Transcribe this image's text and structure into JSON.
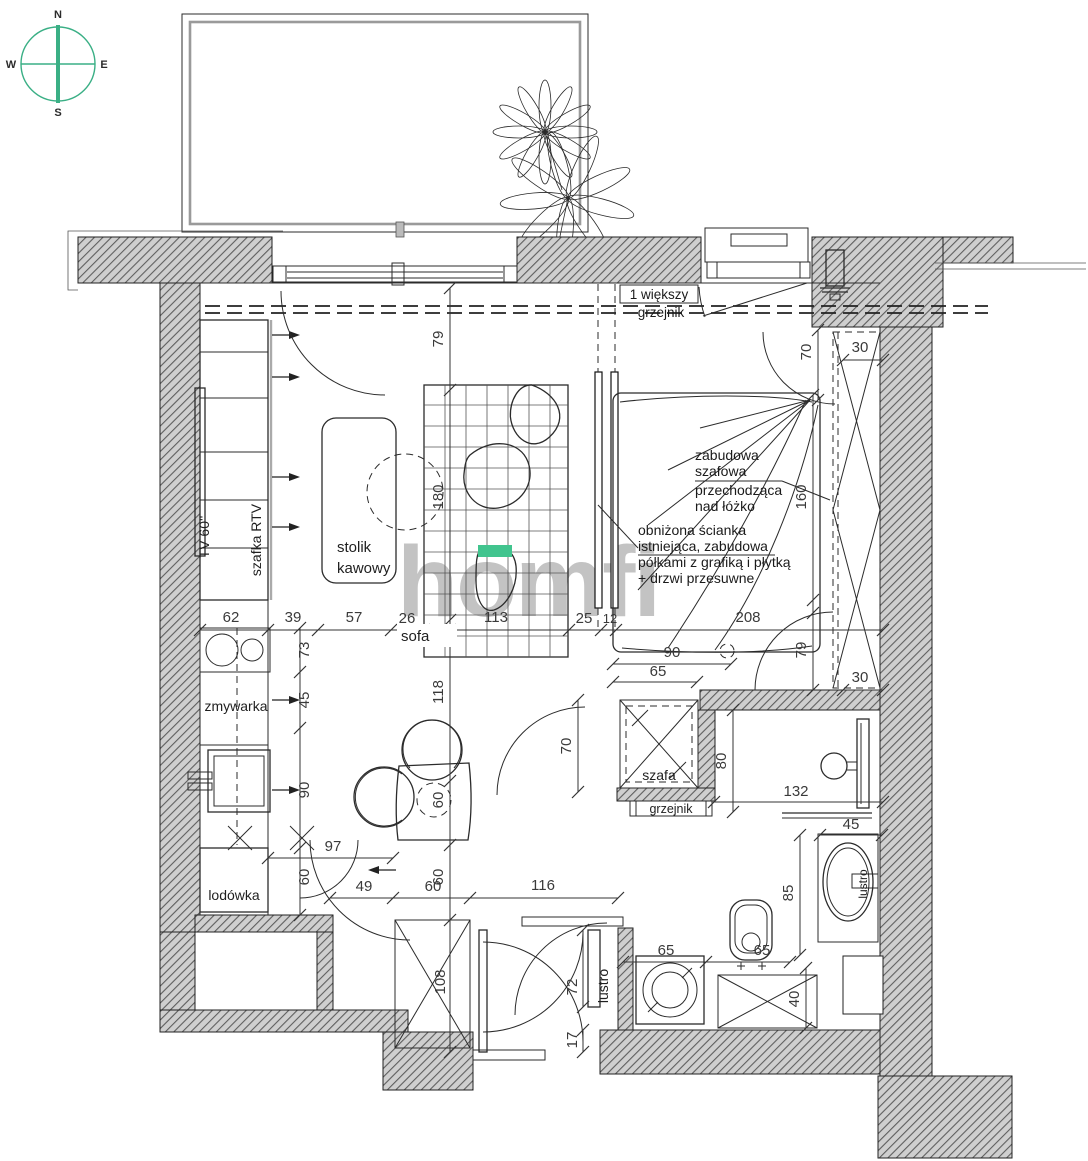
{
  "watermark": "homfi",
  "compass": {
    "n": "N",
    "e": "E",
    "s": "S",
    "w": "W"
  },
  "rooms": {
    "sofa": "sofa",
    "stolik_line1": "stolik",
    "stolik_line2": "kawowy",
    "tv": "TV 60''",
    "szafka_rtv": "szafka RTV",
    "zmywarka": "zmywarka",
    "lodowka": "lodówka",
    "szafa": "szafa",
    "grzejnik": "grzejnik",
    "lustro_bathroom": "lustro",
    "lustro_hall": "lustro"
  },
  "notes": {
    "bigger_radiator_line1": "1 większy",
    "bigger_radiator_line2": "grzejnik",
    "wardrobe_over_bed": [
      "zabudowa",
      "szafowa",
      "przechodząca",
      "nad łóżko"
    ],
    "lowered_wall": [
      "obniżona ścianka",
      "istniejąca, zabudowa",
      "półkami z grafiką i płytką",
      "+ drzwi przesuwne"
    ]
  },
  "dims": {
    "top_chain": [
      "62",
      "39",
      "57",
      "26",
      "113",
      "25",
      "12",
      "208"
    ],
    "living_vertical": [
      "79",
      "180",
      "118",
      "60",
      "60",
      "108"
    ],
    "kitchen_vertical": [
      "73",
      "45",
      "90",
      "60"
    ],
    "bottom_chain": [
      "97",
      "49",
      "60",
      "116"
    ],
    "bedroom": [
      "70",
      "30",
      "160",
      "79",
      "30"
    ],
    "bath": [
      "90",
      "65",
      "70",
      "80",
      "132",
      "45",
      "85"
    ],
    "wc": [
      "65",
      "65",
      "40",
      "72",
      "17"
    ]
  },
  "colors": {
    "accent_green": "#3aaf85",
    "highlight_green": "#41c48e",
    "watermark_gray": "#8d8d8d"
  }
}
